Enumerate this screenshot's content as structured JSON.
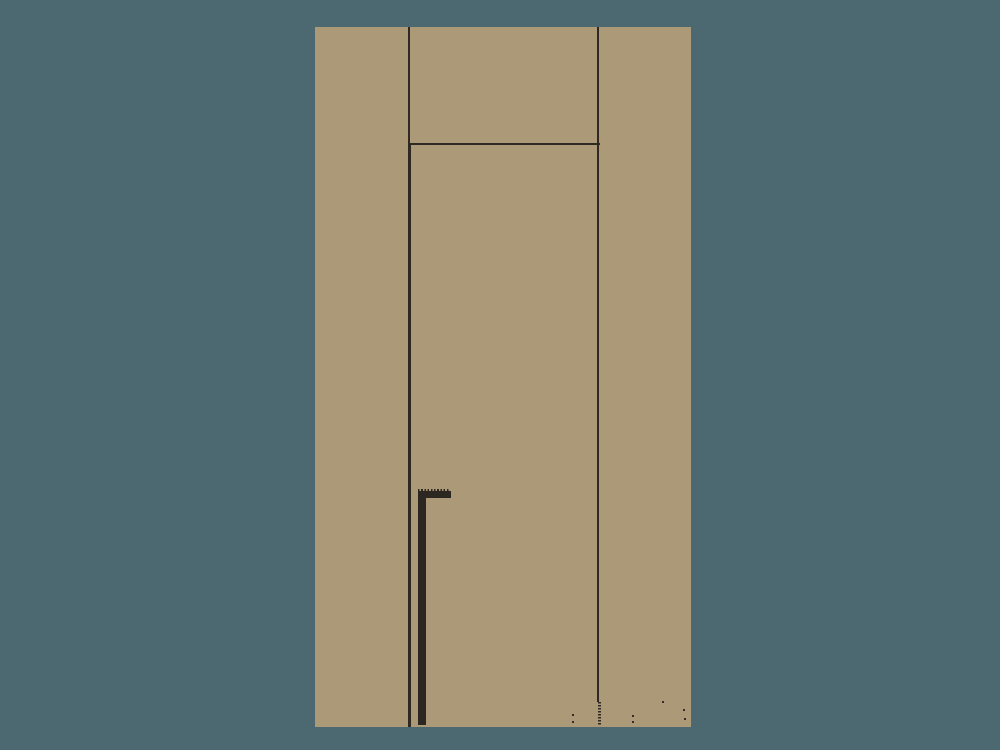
{
  "colors": {
    "background": "#4C6971",
    "sheet": "#AB9977",
    "line": "#2F2923",
    "bar": "#2D2722",
    "speck": "#332D26"
  },
  "drawing": {
    "kind": "architectural-door-elevation",
    "visible_text": [],
    "elements": [
      "sheet",
      "jamb-line-left",
      "jamb-line-right",
      "transom-line",
      "door-panel-outline",
      "door-right-dashed-tail",
      "serrated-l-bar",
      "ink-specks"
    ]
  }
}
